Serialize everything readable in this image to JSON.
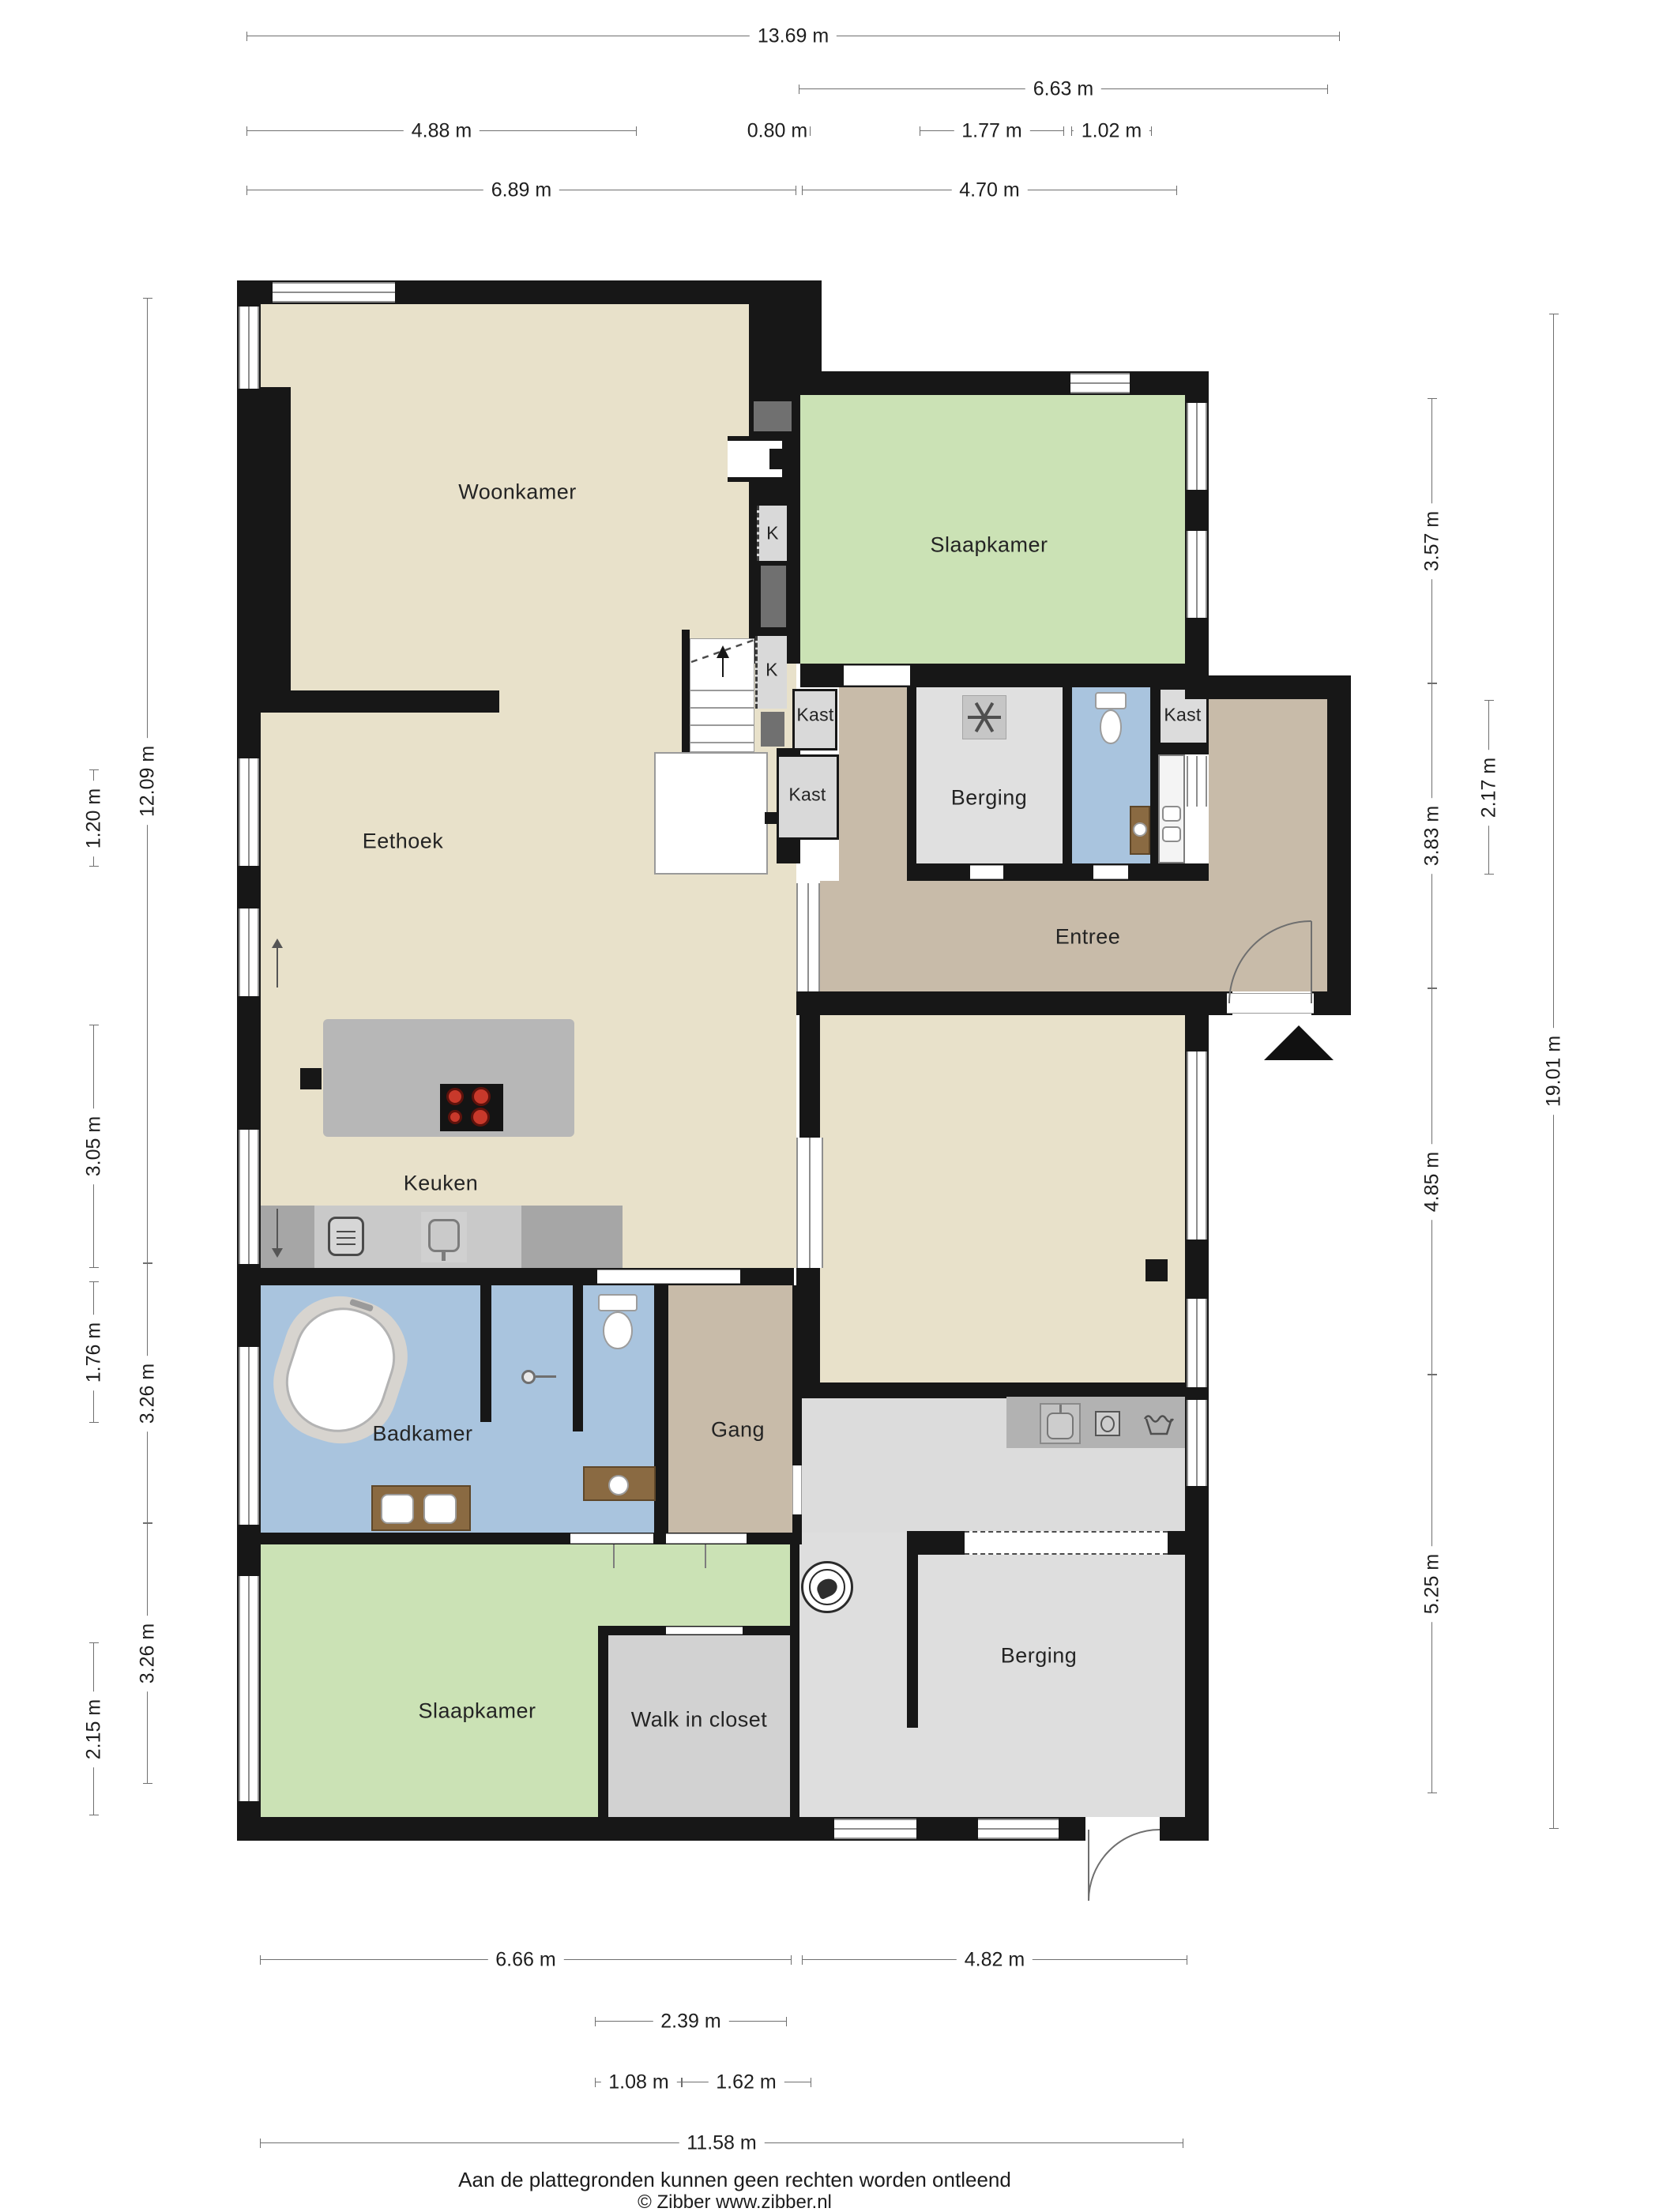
{
  "rooms": {
    "woonkamer": "Woonkamer",
    "eethoek": "Eethoek",
    "keuken": "Keuken",
    "badkamer": "Badkamer",
    "gang": "Gang",
    "slaapkamer_top": "Slaapkamer",
    "slaapkamer_bottom": "Slaapkamer",
    "berging_top": "Berging",
    "berging_bottom": "Berging",
    "entree": "Entree",
    "walk_in_closet": "Walk in closet",
    "kast": "Kast",
    "k": "K"
  },
  "dims": {
    "top": [
      "13.69 m",
      "6.63 m",
      "4.88 m",
      "0.80 m",
      "1.77 m",
      "1.02 m",
      "6.89 m",
      "4.70 m"
    ],
    "left": [
      "1.20 m",
      "3.05 m",
      "1.76 m",
      "2.15 m",
      "12.09 m",
      "3.26 m",
      "3.26 m"
    ],
    "right": [
      "3.57 m",
      "3.83 m",
      "4.85 m",
      "5.25 m",
      "2.17 m",
      "19.01 m"
    ],
    "bottom": [
      "6.66 m",
      "4.82 m",
      "2.39 m",
      "1.08 m",
      "1.62 m",
      "11.58 m"
    ]
  },
  "footer": {
    "disclaimer": "Aan de plattegronden kunnen geen rechten worden ontleend",
    "copyright": "© Zibber www.zibber.nl"
  },
  "colors": {
    "wall": "#171717",
    "floor_living": "#e8e1ca",
    "floor_bedroom": "#cbe2b5",
    "floor_hall": "#c8bba9",
    "floor_bath": "#a9c4de",
    "floor_storage": "#dedede",
    "burner_red": "#c8392b"
  }
}
